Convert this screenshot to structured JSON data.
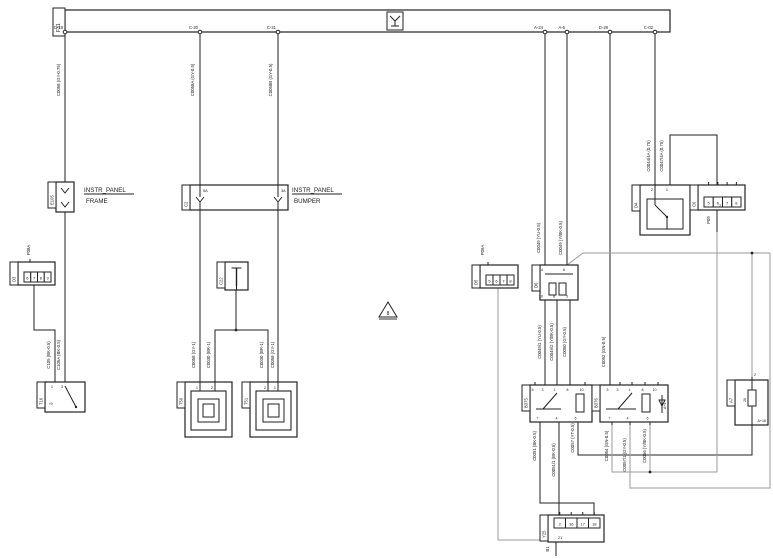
{
  "canvas": {
    "w": 773,
    "h": 559,
    "bg": "#ffffff",
    "black": "#222222",
    "gray": "#9a9a9a"
  },
  "bus": {
    "x": 65,
    "y": 10,
    "w": 605,
    "h": 22,
    "label": "F31",
    "power_symbol": {
      "x": 387,
      "y": 12,
      "w": 16,
      "h": 18
    },
    "pins": [
      {
        "x": 65,
        "label": "C-19"
      },
      {
        "x": 200,
        "label": "C-20"
      },
      {
        "x": 278,
        "label": "C-21"
      },
      {
        "x": 545,
        "label": "A-24"
      },
      {
        "x": 567,
        "label": "A-6"
      },
      {
        "x": 610,
        "label": "D-28"
      },
      {
        "x": 655,
        "label": "C-02"
      }
    ]
  },
  "wires": [
    {
      "name": "bus-drop-c19-upper",
      "pts": [
        [
          65,
          32
        ],
        [
          65,
          182
        ]
      ]
    },
    {
      "name": "bus-drop-c19-lower",
      "pts": [
        [
          65,
          212
        ],
        [
          65,
          382
        ]
      ]
    },
    {
      "name": "d3-to-t16",
      "pts": [
        [
          34,
          285
        ],
        [
          34,
          330
        ],
        [
          55,
          330
        ],
        [
          55,
          382
        ]
      ]
    },
    {
      "name": "bus-drop-c20-upper",
      "pts": [
        [
          200,
          32
        ],
        [
          200,
          185
        ]
      ]
    },
    {
      "name": "bus-drop-c20-lower",
      "pts": [
        [
          200,
          210
        ],
        [
          200,
          382
        ]
      ]
    },
    {
      "name": "bus-drop-c21-upper",
      "pts": [
        [
          278,
          32
        ],
        [
          278,
          185
        ]
      ]
    },
    {
      "name": "bus-drop-c21-lower",
      "pts": [
        [
          278,
          210
        ],
        [
          278,
          382
        ]
      ]
    },
    {
      "name": "splice-to-lamp1",
      "pts": [
        [
          236,
          290
        ],
        [
          236,
          330
        ],
        [
          215,
          330
        ],
        [
          215,
          382
        ]
      ]
    },
    {
      "name": "splice-to-lamp2",
      "pts": [
        [
          236,
          330
        ],
        [
          268,
          330
        ],
        [
          268,
          382
        ]
      ]
    },
    {
      "name": "bus-drop-a24",
      "pts": [
        [
          545,
          32
        ],
        [
          545,
          265
        ]
      ]
    },
    {
      "name": "bus-drop-a6",
      "pts": [
        [
          567,
          32
        ],
        [
          567,
          265
        ]
      ]
    },
    {
      "name": "bus-drop-d28",
      "pts": [
        [
          610,
          32
        ],
        [
          610,
          385
        ]
      ]
    },
    {
      "name": "bus-drop-c02",
      "pts": [
        [
          655,
          32
        ],
        [
          655,
          185
        ]
      ]
    },
    {
      "name": "d4-to-c6",
      "pts": [
        [
          670,
          185
        ],
        [
          670,
          135
        ],
        [
          717,
          135
        ],
        [
          717,
          185
        ]
      ]
    },
    {
      "name": "c6-pin21-stub",
      "pts": [
        [
          717,
          210
        ],
        [
          717,
          232
        ]
      ]
    },
    {
      "name": "d6-to-b375-a",
      "pts": [
        [
          545,
          300
        ],
        [
          545,
          385
        ]
      ]
    },
    {
      "name": "d6-to-b375-b",
      "pts": [
        [
          557,
          300
        ],
        [
          557,
          385
        ]
      ]
    },
    {
      "name": "d6-to-b375-c",
      "pts": [
        [
          570,
          300
        ],
        [
          570,
          385
        ]
      ]
    },
    {
      "name": "b375-7-to-y25",
      "pts": [
        [
          540,
          422
        ],
        [
          540,
          503
        ],
        [
          594,
          503
        ],
        [
          594,
          515
        ]
      ]
    },
    {
      "name": "b375-4-to-y25",
      "pts": [
        [
          559,
          422
        ],
        [
          559,
          515
        ]
      ]
    },
    {
      "name": "b375-6-to-a7",
      "pts": [
        [
          578,
          422
        ],
        [
          578,
          455
        ],
        [
          752,
          455
        ],
        [
          752,
          428
        ]
      ]
    },
    {
      "name": "y25-pin21-down",
      "pts": [
        [
          556,
          542
        ],
        [
          556,
          556
        ]
      ]
    },
    {
      "name": "d6-to-a7-loop",
      "color": "gray",
      "pts": [
        [
          567,
          265
        ],
        [
          583,
          253
        ],
        [
          770,
          253
        ]
      ]
    },
    {
      "name": "a7-top-feed",
      "color": "gray",
      "pts": [
        [
          752,
          253
        ],
        [
          752,
          380
        ]
      ]
    },
    {
      "name": "b376-7-to-c6",
      "color": "gray",
      "pts": [
        [
          612,
          422
        ],
        [
          612,
          472
        ],
        [
          717,
          472
        ],
        [
          717,
          232
        ]
      ]
    },
    {
      "name": "b376-4-loop",
      "color": "gray",
      "pts": [
        [
          630,
          422
        ],
        [
          630,
          488
        ],
        [
          770,
          488
        ],
        [
          770,
          253
        ]
      ]
    },
    {
      "name": "b376-6-join",
      "color": "gray",
      "pts": [
        [
          650,
          422
        ],
        [
          650,
          472
        ]
      ]
    },
    {
      "name": "d5-to-y25",
      "color": "gray",
      "pts": [
        [
          498,
          288
        ],
        [
          498,
          540
        ],
        [
          548,
          540
        ]
      ]
    }
  ],
  "junctions": [
    [
      236,
      330
    ],
    [
      650,
      472
    ],
    [
      752,
      253
    ]
  ],
  "components": [
    {
      "id": "e105",
      "kind": "inline2",
      "x": 56,
      "y": 182,
      "w": 18,
      "h": 30,
      "flange": "E105"
    },
    {
      "id": "c2-bumper",
      "kind": "passbox",
      "x": 190,
      "y": 185,
      "w": 98,
      "h": 25,
      "flange": "C2",
      "pins": [
        {
          "x": 200,
          "label": "5A"
        },
        {
          "x": 278,
          "label": "3A"
        }
      ]
    },
    {
      "id": "d3-left",
      "kind": "conn",
      "x": 18,
      "y": 262,
      "w": 37,
      "h": 23,
      "flange": "D3",
      "cells": [
        "6",
        "7",
        "8",
        "9"
      ],
      "cells_at": "bottom",
      "ticks": [
        {
          "edge": "top",
          "x": 30
        }
      ]
    },
    {
      "id": "c22-splice",
      "kind": "splice",
      "x": 225,
      "y": 262,
      "w": 23,
      "h": 28,
      "flange": "C22"
    },
    {
      "id": "t16",
      "kind": "switch",
      "x": 45,
      "y": 382,
      "w": 40,
      "h": 30,
      "flange": "T16",
      "top_pins": [
        {
          "x": 55,
          "label": "1"
        },
        {
          "x": 65,
          "label": "3"
        }
      ],
      "side_label": "›9"
    },
    {
      "id": "t50-lamp",
      "kind": "lamp",
      "x": 185,
      "y": 382,
      "w": 47,
      "h": 55,
      "flange": "T50",
      "top_pins": [
        {
          "x": 200,
          "label": "1"
        },
        {
          "x": 215,
          "label": "2"
        }
      ]
    },
    {
      "id": "t51-lamp",
      "kind": "lamp",
      "x": 250,
      "y": 382,
      "w": 47,
      "h": 55,
      "flange": "T51",
      "top_pins": [
        {
          "x": 268,
          "label": "2"
        },
        {
          "x": 278,
          "label": "1"
        }
      ]
    },
    {
      "id": "d5-right",
      "kind": "conn",
      "x": 480,
      "y": 265,
      "w": 38,
      "h": 23,
      "flange": "D5",
      "cells": [
        "5",
        "6",
        "7",
        "8"
      ],
      "cells_at": "bottom",
      "ticks": [
        {
          "edge": "top",
          "x": 488
        }
      ]
    },
    {
      "id": "d6",
      "kind": "pins4",
      "x": 540,
      "y": 265,
      "w": 38,
      "h": 35,
      "flange": "D6",
      "pins": [
        {
          "x": 545,
          "edge": "top",
          "label": "4"
        },
        {
          "x": 567,
          "edge": "top",
          "label": "6"
        },
        {
          "x": 545,
          "edge": "bottom",
          "label": "10"
        },
        {
          "x": 557,
          "edge": "bottom",
          "label": "8"
        },
        {
          "x": 570,
          "edge": "bottom",
          "label": "5"
        }
      ]
    },
    {
      "id": "d4",
      "kind": "switchbox",
      "x": 640,
      "y": 185,
      "w": 50,
      "h": 50,
      "flange": "D4",
      "top_pins": [
        {
          "x": 655,
          "label": "2"
        },
        {
          "x": 670,
          "label": "1"
        }
      ]
    },
    {
      "id": "c6",
      "kind": "conn",
      "x": 698,
      "y": 185,
      "w": 47,
      "h": 25,
      "flange": "C6",
      "cells": [
        "5",
        "6",
        "7",
        "8"
      ],
      "cells_at": "bottom",
      "ticks_cells": "top",
      "bottom_pin": {
        "x": 717,
        "label": "21"
      }
    },
    {
      "id": "b375-relay",
      "kind": "relay",
      "x": 530,
      "y": 385,
      "w": 62,
      "h": 37,
      "flange": "B375",
      "top_pins": [
        {
          "x": 535,
          "label": "5"
        },
        {
          "x": 545,
          "label": "3"
        },
        {
          "x": 557,
          "label": "1"
        },
        {
          "x": 570,
          "label": "8"
        },
        {
          "x": 585,
          "label": "10"
        }
      ],
      "bottom_pins": [
        {
          "x": 540,
          "label": "7"
        },
        {
          "x": 559,
          "label": "4"
        },
        {
          "x": 578,
          "label": "6"
        }
      ],
      "sw_pin": 557
    },
    {
      "id": "b376-relay",
      "kind": "relay",
      "x": 600,
      "y": 385,
      "w": 68,
      "h": 37,
      "flange": "B376",
      "top_pins": [
        {
          "x": 610,
          "label": "5"
        },
        {
          "x": 620,
          "label": "3"
        },
        {
          "x": 632,
          "label": "1"
        },
        {
          "x": 645,
          "label": "8"
        },
        {
          "x": 658,
          "label": "10"
        }
      ],
      "bottom_pins": [
        {
          "x": 612,
          "label": "7"
        },
        {
          "x": 630,
          "label": "4"
        },
        {
          "x": 650,
          "label": "6"
        }
      ],
      "sw_pin": 632,
      "diode": true,
      "inner_label": "A+4"
    },
    {
      "id": "a7-resistor",
      "kind": "resistor",
      "x": 735,
      "y": 380,
      "w": 33,
      "h": 45,
      "flange": "A7",
      "top_pin": {
        "x": 752,
        "label": "2"
      },
      "bottom_pin": {
        "x": 752
      },
      "inner_labels": {
        "left": "26",
        "corner": "A+16"
      }
    },
    {
      "id": "y25",
      "kind": "conn",
      "x": 548,
      "y": 515,
      "w": 56,
      "h": 27,
      "flange": "Y25",
      "cells": [
        "2",
        "16",
        "17",
        "18"
      ],
      "cells_at": "top",
      "ticks_cells": "top",
      "bottom_pin": {
        "x": 556,
        "label": "21"
      }
    }
  ],
  "wire_labels": [
    {
      "x": 60,
      "y": 80,
      "text": "C0058 (GY-0.75)"
    },
    {
      "x": 194,
      "y": 80,
      "text": "C0058A (GY-0.5)"
    },
    {
      "x": 272,
      "y": 80,
      "text": "C0058B (GY-0.5)"
    },
    {
      "x": 30,
      "y": 250,
      "text": "P08A"
    },
    {
      "x": 50,
      "y": 355,
      "text": "C105 (BK-0.5)"
    },
    {
      "x": 60,
      "y": 355,
      "text": "C105A (BK-0.5)"
    },
    {
      "x": 195,
      "y": 355,
      "text": "C0058 (GY-1)"
    },
    {
      "x": 210,
      "y": 355,
      "text": "C0030 (BR-1)"
    },
    {
      "x": 263,
      "y": 355,
      "text": "C0030 (BR-1)"
    },
    {
      "x": 274,
      "y": 355,
      "text": "C0058 (GY-1)"
    },
    {
      "x": 484,
      "y": 250,
      "text": "P09A"
    },
    {
      "x": 540,
      "y": 238,
      "text": "C0049 (YU-0.5)"
    },
    {
      "x": 562,
      "y": 238,
      "text": "C0049 (Y/BK-0.5)"
    },
    {
      "x": 650,
      "y": 156,
      "text": "C0044/4A (0.75)"
    },
    {
      "x": 663,
      "y": 156,
      "text": "C0047/4A (0.75)"
    },
    {
      "x": 710,
      "y": 220,
      "text": "P09"
    },
    {
      "x": 541,
      "y": 342,
      "text": "C0049/1 (YU-0.5)"
    },
    {
      "x": 553,
      "y": 342,
      "text": "C0049/2 (Y/BK-0.5)"
    },
    {
      "x": 566,
      "y": 342,
      "text": "C0050 (GY-0.5)"
    },
    {
      "x": 605,
      "y": 352,
      "text": "C0052 (GN-0.5)"
    },
    {
      "x": 536,
      "y": 446,
      "text": "C0051 (BK-0.5)"
    },
    {
      "x": 555,
      "y": 460,
      "text": "C0051/1 (BK-0.5)"
    },
    {
      "x": 574,
      "y": 438,
      "text": "C0057 (YT-0.5)"
    },
    {
      "x": 608,
      "y": 446,
      "text": "C0054 (GN-0.5)"
    },
    {
      "x": 626,
      "y": 455,
      "text": "C0057/1 (GY-0.5)"
    },
    {
      "x": 646,
      "y": 446,
      "text": "C0056 (Y/BK-0.5)"
    },
    {
      "x": 549,
      "y": 549,
      "text": "B1"
    }
  ],
  "instr_blocks": [
    {
      "x": 84,
      "y": 192,
      "line1": "INSTR_PANEL",
      "line2": "FRAME",
      "ul_w": 50
    },
    {
      "x": 292,
      "y": 192,
      "line1": "INSTR_PANEL",
      "line2": "BUMPER",
      "ul_w": 50
    }
  ],
  "triangle": {
    "cx": 388,
    "top_y": 302,
    "base_y": 317,
    "half": 9,
    "label": "8"
  }
}
